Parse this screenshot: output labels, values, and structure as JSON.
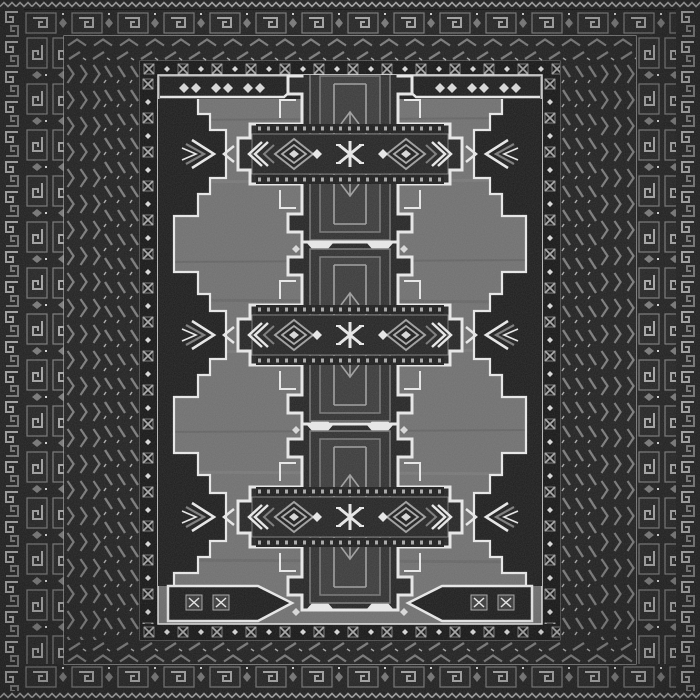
{
  "image": {
    "type": "photograph",
    "subject": "hand-knotted tribal rug (Baluch style) seen flat from above, filling the frame",
    "tonality": "dark charcoal, black and grey wool with ivory-white accent outlines"
  },
  "palette": {
    "edge": "#101010",
    "border_ground": "#1f1f1f",
    "guard_ground": "#141414",
    "border_motif": "#7a7a7a",
    "border_motif_bright": "#a8a8a8",
    "field": "#6f6f6f",
    "panel_dark": "#1b1b1b",
    "medallion_core": "#232323",
    "medallion_panel": "#2f2f2f",
    "medallion_panel_inner": "#3a3a3a",
    "medallion_line": "#787878",
    "lattice_line": "#9e9e9e",
    "white_accent": "#e9e9e9",
    "rosette_white": "#d9d9d9"
  },
  "rug": {
    "medallion_count": 3,
    "medallion_center_x": 350,
    "medallion_centers_y": [
      154,
      335,
      517
    ],
    "side_arrow_centers_y": [
      154,
      335,
      517
    ],
    "side_arrow_x_left": 218,
    "side_arrow_x_right": 482,
    "borders_outer_to_inner": [
      "zigzag edge guard",
      "hook-meander guard (sides)",
      "compartment band with hooked boxes and diamonds",
      "chevron band",
      "diagonal slash band",
      "rosette-and-dot inner guard"
    ],
    "field_motifs": [
      "three stepped-cross medallions with white outlines",
      "lattice diamond and chevron arm bands",
      "central white star knots",
      "side zigzag panels with nested arrow chevrons",
      "white bracket motifs in top corners",
      "white arrow-box motifs in bottom corners"
    ]
  }
}
